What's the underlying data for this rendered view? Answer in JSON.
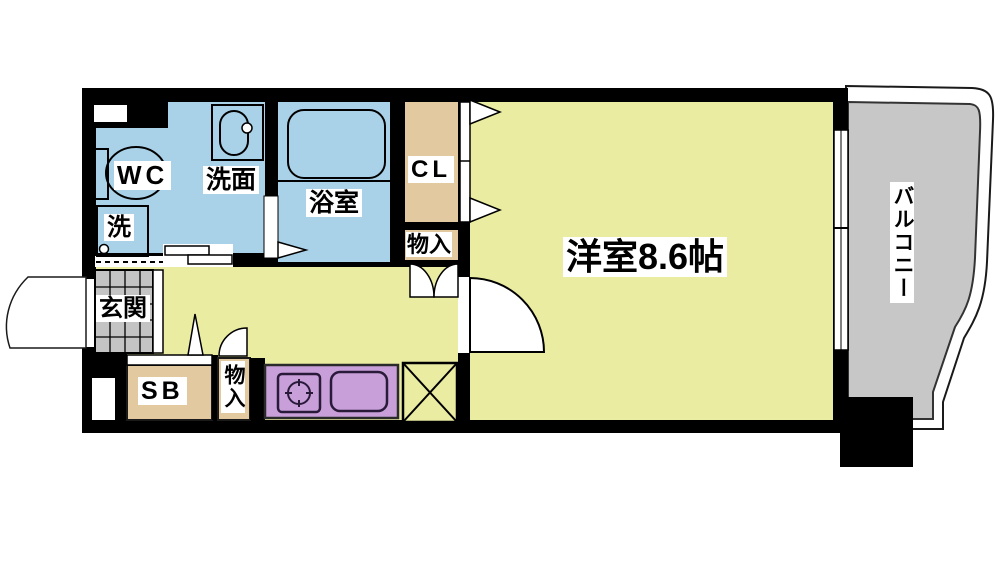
{
  "floorplan": {
    "labels": {
      "wc": "WC",
      "washroom": "洗面",
      "bathroom": "浴室",
      "washer": "洗",
      "closet": "CL",
      "storage_upper": "物入",
      "entrance": "玄関",
      "shoe_box": "SB",
      "storage_lower": "物入",
      "main_room": "洋室8.6帖",
      "balcony": "バルコニー"
    },
    "colors": {
      "wall": "#000000",
      "wet_area_blue": "#a9d2e9",
      "room_yellow": "#eaeca2",
      "storage_tan": "#e2c9a0",
      "kitchen_purple": "#c89fd9",
      "balcony_gray": "#c7c7c7",
      "entrance_gray": "#c4c4c4",
      "door_white": "#ffffff"
    }
  }
}
